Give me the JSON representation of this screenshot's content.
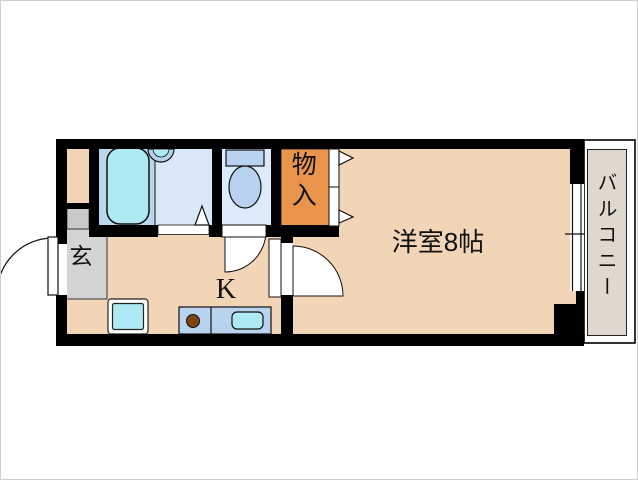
{
  "floorplan": {
    "labels": {
      "entrance": "玄",
      "kitchen": "K",
      "western_room": "洋室8帖",
      "closet": "物入",
      "balcony": "バルコニー"
    },
    "colors": {
      "wall": "#000000",
      "floor_peach": "#f2d4b6",
      "closet_orange": "#e8944d",
      "bath_zone_left": "#bcd6ee",
      "bath_zone_right": "#d9e8f7",
      "toilet_floor": "#dcebf9",
      "fixture_blue": "#b9d2f0",
      "counter_blue": "#b9d2ee",
      "cyan_fixture": "#aeeaf3",
      "entrance_gray": "#d4d4d4",
      "shoe_cabinet_gray": "#c9c9c9",
      "balcony_floor": "#ded8cf",
      "burner_brown": "#7a4513",
      "door_white": "#ffffff"
    }
  }
}
